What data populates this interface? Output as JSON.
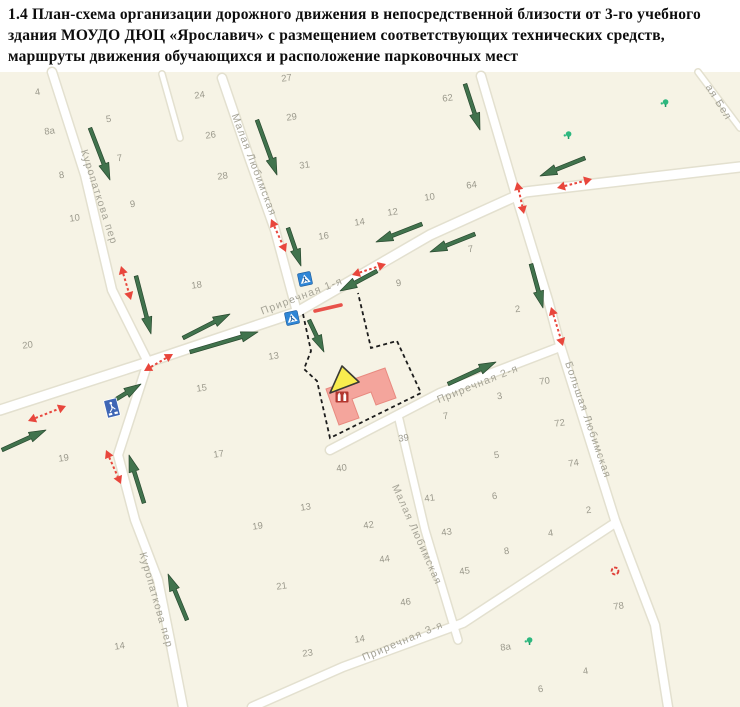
{
  "title": "1.4 План-схема организации дорожного движения в непосредственной близости от 3-го учебного здания МОУДО ДЮЦ «Ярославич» с размещением соответствующих технических средств, маршруты движения обучающихся и расположение парковочных мест",
  "icons": {
    "pedestrian_crossing_sign": "blue square sign 5.19 with white triangle and walking figure",
    "parking_sign": "blue rectangular sign with white pedestrian pictogram",
    "children_warning_triangle": "yellow warning triangle at school building",
    "school_building_icon": "dark-red building glyph on school footprint",
    "tree_icon": "small green tree/vegetation marker",
    "poi_red_icon": "small red circular point of interest"
  },
  "map": {
    "top": 72,
    "colors": {
      "bg": "#f6f3e5",
      "street_fill": "#ffffff",
      "street_casing": "#e3e0cf",
      "street_label": "#a5a396",
      "house_number": "#9b998c",
      "route_green": "#41734d",
      "route_green_edge": "#29492f",
      "vehicle_red": "#e8463c",
      "sign_blue": "#2f86d6",
      "parking_blue": "#3f66b5",
      "building_fill": "#f4a59c",
      "building_stroke": "#e8897f",
      "triangle_fill": "#f8ec4e",
      "triangle_stroke": "#3a3a34",
      "boundary_black": "#1c1c1c",
      "tree_green": "#2db87f",
      "poi_red": "#e04038",
      "crossing_line": "#e8524a"
    },
    "streets": [
      {
        "name": "Куропаткова пер (север)",
        "width": 8,
        "points": [
          [
            52,
            72
          ],
          [
            85,
            175
          ],
          [
            112,
            290
          ],
          [
            148,
            362
          ],
          [
            118,
            455
          ],
          [
            135,
            520
          ],
          [
            158,
            580
          ],
          [
            170,
            640
          ],
          [
            183,
            707
          ]
        ]
      },
      {
        "name": "Малая Любимская (север)",
        "width": 8,
        "points": [
          [
            222,
            78
          ],
          [
            250,
            160
          ],
          [
            275,
            230
          ],
          [
            297,
            312
          ]
        ]
      },
      {
        "name": "Приречная 1-я",
        "width": 9,
        "points": [
          [
            0,
            410
          ],
          [
            148,
            362
          ],
          [
            297,
            312
          ],
          [
            430,
            235
          ],
          [
            525,
            192
          ],
          [
            740,
            167
          ]
        ]
      },
      {
        "name": "Большая Любимская",
        "width": 8,
        "points": [
          [
            481,
            76
          ],
          [
            515,
            192
          ],
          [
            548,
            300
          ],
          [
            560,
            345
          ],
          [
            615,
            520
          ],
          [
            655,
            625
          ],
          [
            668,
            707
          ]
        ]
      },
      {
        "name": "Приречная 2-я",
        "width": 8,
        "points": [
          [
            330,
            450
          ],
          [
            440,
            393
          ],
          [
            560,
            347
          ]
        ]
      },
      {
        "name": "Малая Любимская (юг)",
        "width": 7,
        "points": [
          [
            398,
            415
          ],
          [
            425,
            530
          ],
          [
            458,
            640
          ]
        ]
      },
      {
        "name": "Приречная 3-я",
        "width": 8,
        "points": [
          [
            252,
            707
          ],
          [
            343,
            667
          ],
          [
            463,
            623
          ],
          [
            612,
            525
          ]
        ]
      },
      {
        "name": "проезд",
        "width": 5,
        "points": [
          [
            162,
            74
          ],
          [
            180,
            138
          ]
        ]
      },
      {
        "name": "улица (угол)",
        "width": 5,
        "points": [
          [
            698,
            72
          ],
          [
            740,
            128
          ]
        ]
      }
    ],
    "street_labels": [
      {
        "text": "Куропаткова пер",
        "x": 96,
        "y": 198,
        "rotate": 72
      },
      {
        "text": "Куропаткова пер",
        "x": 153,
        "y": 601,
        "rotate": 74
      },
      {
        "text": "Малая Любимская",
        "x": 251,
        "y": 166,
        "rotate": 69
      },
      {
        "text": "Малая Любимская",
        "x": 414,
        "y": 536,
        "rotate": 66
      },
      {
        "text": "Приречная 1-я",
        "x": 303,
        "y": 299,
        "rotate": -21
      },
      {
        "text": "Приречная 2-я",
        "x": 479,
        "y": 387,
        "rotate": -22
      },
      {
        "text": "Приречная 3-я",
        "x": 404,
        "y": 644,
        "rotate": -23
      },
      {
        "text": "Большая Любимская",
        "x": 585,
        "y": 421,
        "rotate": 71
      },
      {
        "text": "ая Бел",
        "x": 716,
        "y": 104,
        "rotate": 58
      }
    ],
    "house_numbers": [
      {
        "t": "4",
        "x": 38,
        "y": 95
      },
      {
        "t": "24",
        "x": 200,
        "y": 98
      },
      {
        "t": "27",
        "x": 287,
        "y": 81
      },
      {
        "t": "62",
        "x": 448,
        "y": 101
      },
      {
        "t": "8а",
        "x": 50,
        "y": 134
      },
      {
        "t": "5",
        "x": 109,
        "y": 122
      },
      {
        "t": "26",
        "x": 211,
        "y": 138
      },
      {
        "t": "29",
        "x": 292,
        "y": 120
      },
      {
        "t": "8",
        "x": 62,
        "y": 178
      },
      {
        "t": "7",
        "x": 120,
        "y": 161
      },
      {
        "t": "28",
        "x": 223,
        "y": 179
      },
      {
        "t": "31",
        "x": 305,
        "y": 168
      },
      {
        "t": "10",
        "x": 75,
        "y": 221
      },
      {
        "t": "9",
        "x": 133,
        "y": 207
      },
      {
        "t": "16",
        "x": 324,
        "y": 239
      },
      {
        "t": "14",
        "x": 360,
        "y": 225
      },
      {
        "t": "12",
        "x": 393,
        "y": 215
      },
      {
        "t": "10",
        "x": 430,
        "y": 200
      },
      {
        "t": "64",
        "x": 472,
        "y": 188
      },
      {
        "t": "18",
        "x": 197,
        "y": 288
      },
      {
        "t": "9",
        "x": 399,
        "y": 286
      },
      {
        "t": "7",
        "x": 471,
        "y": 252
      },
      {
        "t": "2",
        "x": 518,
        "y": 312
      },
      {
        "t": "20",
        "x": 28,
        "y": 348
      },
      {
        "t": "13",
        "x": 274,
        "y": 359
      },
      {
        "t": "15",
        "x": 202,
        "y": 391
      },
      {
        "t": "19",
        "x": 64,
        "y": 461
      },
      {
        "t": "17",
        "x": 219,
        "y": 457
      },
      {
        "t": "39",
        "x": 404,
        "y": 441
      },
      {
        "t": "40",
        "x": 342,
        "y": 471
      },
      {
        "t": "7",
        "x": 446,
        "y": 419
      },
      {
        "t": "3",
        "x": 500,
        "y": 399
      },
      {
        "t": "70",
        "x": 545,
        "y": 384
      },
      {
        "t": "5",
        "x": 497,
        "y": 458
      },
      {
        "t": "72",
        "x": 560,
        "y": 426
      },
      {
        "t": "74",
        "x": 574,
        "y": 466
      },
      {
        "t": "6",
        "x": 495,
        "y": 499
      },
      {
        "t": "2",
        "x": 589,
        "y": 513
      },
      {
        "t": "13",
        "x": 306,
        "y": 510
      },
      {
        "t": "19",
        "x": 258,
        "y": 529
      },
      {
        "t": "21",
        "x": 282,
        "y": 589
      },
      {
        "t": "23",
        "x": 308,
        "y": 656
      },
      {
        "t": "14",
        "x": 120,
        "y": 649
      },
      {
        "t": "14",
        "x": 360,
        "y": 642
      },
      {
        "t": "41",
        "x": 430,
        "y": 501
      },
      {
        "t": "42",
        "x": 369,
        "y": 528
      },
      {
        "t": "43",
        "x": 447,
        "y": 535
      },
      {
        "t": "44",
        "x": 385,
        "y": 562
      },
      {
        "t": "46",
        "x": 406,
        "y": 605
      },
      {
        "t": "45",
        "x": 465,
        "y": 574
      },
      {
        "t": "8",
        "x": 507,
        "y": 554
      },
      {
        "t": "4",
        "x": 551,
        "y": 536
      },
      {
        "t": "78",
        "x": 619,
        "y": 609
      },
      {
        "t": "8а",
        "x": 506,
        "y": 650
      },
      {
        "t": "4",
        "x": 586,
        "y": 674
      },
      {
        "t": "6",
        "x": 541,
        "y": 692
      }
    ],
    "pedestrian_routes": [
      [
        90,
        128,
        110,
        180
      ],
      [
        257,
        120,
        277,
        175
      ],
      [
        288,
        228,
        301,
        266
      ],
      [
        136,
        276,
        151,
        334
      ],
      [
        183,
        338,
        230,
        314
      ],
      [
        190,
        352,
        258,
        332
      ],
      [
        377,
        271,
        340,
        291
      ],
      [
        309,
        320,
        324,
        352
      ],
      [
        448,
        384,
        496,
        362
      ],
      [
        465,
        84,
        480,
        130
      ],
      [
        585,
        158,
        540,
        176
      ],
      [
        422,
        224,
        376,
        242
      ],
      [
        475,
        234,
        430,
        252
      ],
      [
        187,
        620,
        168,
        574
      ],
      [
        144,
        503,
        129,
        455
      ],
      [
        2,
        450,
        46,
        430
      ],
      [
        531,
        264,
        543,
        308
      ],
      [
        110,
        403,
        141,
        384
      ]
    ],
    "vehicle_routes": [
      [
        121,
        266,
        131,
        300
      ],
      [
        144,
        371,
        173,
        354
      ],
      [
        271,
        219,
        286,
        252
      ],
      [
        352,
        275,
        386,
        264
      ],
      [
        517,
        182,
        524,
        214
      ],
      [
        551,
        307,
        563,
        346
      ],
      [
        557,
        188,
        592,
        179
      ],
      [
        28,
        421,
        66,
        406
      ],
      [
        106,
        450,
        121,
        484
      ]
    ],
    "crossing_signs": [
      {
        "x": 305,
        "y": 279,
        "rotate": -12
      },
      {
        "x": 292,
        "y": 318,
        "rotate": -12
      }
    ],
    "parking_sign": {
      "x": 112,
      "y": 408,
      "rotate": -14
    },
    "crossing_marker_line": [
      315,
      311,
      341,
      305
    ],
    "school": {
      "boundary": [
        [
          303,
          314
        ],
        [
          311,
          351
        ],
        [
          304,
          369
        ],
        [
          317,
          381
        ],
        [
          330,
          438
        ],
        [
          421,
          393
        ],
        [
          397,
          341
        ],
        [
          371,
          348
        ],
        [
          358,
          293
        ]
      ],
      "building": [
        [
          326,
          389
        ],
        [
          385,
          368
        ],
        [
          396,
          398
        ],
        [
          376,
          405
        ],
        [
          371,
          392
        ],
        [
          352,
          399
        ],
        [
          359,
          418
        ],
        [
          339,
          425
        ]
      ],
      "warning_triangle": [
        [
          330,
          393
        ],
        [
          359,
          382
        ],
        [
          342,
          366
        ]
      ],
      "icon": {
        "x": 342,
        "y": 397
      }
    },
    "trees": [
      [
        568,
        135
      ],
      [
        665,
        103
      ],
      [
        529,
        641
      ]
    ],
    "poi_red": [
      [
        615,
        571
      ]
    ]
  }
}
